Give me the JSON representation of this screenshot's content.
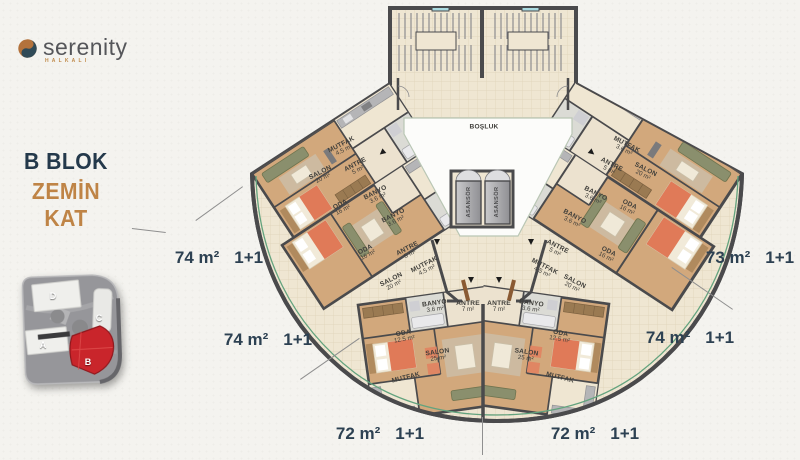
{
  "logo": {
    "name": "serenity",
    "subtitle": "HALKALI"
  },
  "headline": {
    "block": "B BLOK",
    "floor": "ZEMİN KAT"
  },
  "site_map": {
    "blocks": [
      {
        "label": "D",
        "x": 53,
        "y": 296,
        "highlighted": false
      },
      {
        "label": "C",
        "x": 99,
        "y": 318,
        "highlighted": false
      },
      {
        "label": "A",
        "x": 43,
        "y": 345,
        "highlighted": false
      },
      {
        "label": "B",
        "x": 88,
        "y": 362,
        "highlighted": true
      }
    ],
    "highlight_color": "#c9252b"
  },
  "unit_labels": [
    {
      "area": "74 m²",
      "type": "1+1",
      "x": 219,
      "y": 258
    },
    {
      "area": "74 m²",
      "type": "1+1",
      "x": 268,
      "y": 340
    },
    {
      "area": "72 m²",
      "type": "1+1",
      "x": 380,
      "y": 434
    },
    {
      "area": "72 m²",
      "type": "1+1",
      "x": 595,
      "y": 434
    },
    {
      "area": "74 m²",
      "type": "1+1",
      "x": 690,
      "y": 338
    },
    {
      "area": "73 m²",
      "type": "1+1",
      "x": 750,
      "y": 258
    }
  ],
  "room_labels": [
    {
      "t": "MUTFAK",
      "a": "4.5 m²",
      "x": 343,
      "y": 148,
      "r": -27
    },
    {
      "t": "ANTRE",
      "a": "5 m²",
      "x": 357,
      "y": 168,
      "r": -27
    },
    {
      "t": "SALON",
      "a": "20 m²",
      "x": 322,
      "y": 176,
      "r": -27
    },
    {
      "t": "ODA",
      "a": "16 m²",
      "x": 342,
      "y": 208,
      "r": -27
    },
    {
      "t": "BANYO",
      "a": "3.6 m²",
      "x": 377,
      "y": 196,
      "r": -27
    },
    {
      "t": "BANYO",
      "a": "3.6 m²",
      "x": 395,
      "y": 219,
      "r": -27
    },
    {
      "t": "ODA",
      "a": "16 m²",
      "x": 367,
      "y": 253,
      "r": -27
    },
    {
      "t": "ANTRE",
      "a": "5 m²",
      "x": 409,
      "y": 252,
      "r": -27
    },
    {
      "t": "MUTFAK",
      "a": "4.5 m²",
      "x": 426,
      "y": 268,
      "r": -27
    },
    {
      "t": "SALON",
      "a": "20 m²",
      "x": 393,
      "y": 283,
      "r": -27
    },
    {
      "t": "ODA",
      "a": "12.5 m²",
      "x": 404,
      "y": 337,
      "r": -10
    },
    {
      "t": "SALON",
      "a": "25 m²",
      "x": 438,
      "y": 356,
      "r": -8
    },
    {
      "t": "MUTFAK",
      "a": "",
      "x": 406,
      "y": 378,
      "r": -14
    },
    {
      "t": "BANYO",
      "a": "3.6 m²",
      "x": 435,
      "y": 307,
      "r": -8
    },
    {
      "t": "ANTRE",
      "a": "7 m²",
      "x": 468,
      "y": 307,
      "r": 0
    },
    {
      "t": "BOŞLUK",
      "a": "",
      "x": 484,
      "y": 127,
      "r": 0
    },
    {
      "t": "ASANSÖR",
      "a": "",
      "x": 469,
      "y": 202,
      "r": -90,
      "k": "v"
    },
    {
      "t": "ASANSÖR",
      "a": "",
      "x": 497,
      "y": 202,
      "r": -90,
      "k": "v"
    },
    {
      "t": "ANTRE",
      "a": "7 m²",
      "x": 499,
      "y": 307,
      "r": 0
    },
    {
      "t": "BANYO",
      "a": "3.6 m²",
      "x": 531,
      "y": 307,
      "r": 8
    },
    {
      "t": "SALON",
      "a": "25 m²",
      "x": 526,
      "y": 356,
      "r": 8
    },
    {
      "t": "ODA",
      "a": "12.5 m²",
      "x": 560,
      "y": 337,
      "r": 10
    },
    {
      "t": "MUTFAK",
      "a": "",
      "x": 560,
      "y": 378,
      "r": 14
    },
    {
      "t": "SALON",
      "a": "20 m²",
      "x": 573,
      "y": 285,
      "r": 27
    },
    {
      "t": "MUTFAK",
      "a": "4.5 m²",
      "x": 543,
      "y": 270,
      "r": 27
    },
    {
      "t": "ANTRE",
      "a": "5 m²",
      "x": 556,
      "y": 250,
      "r": 27
    },
    {
      "t": "ODA",
      "a": "16 m²",
      "x": 607,
      "y": 255,
      "r": 27
    },
    {
      "t": "BANYO",
      "a": "3.6 m²",
      "x": 573,
      "y": 220,
      "r": 27
    },
    {
      "t": "BANYO",
      "a": "3.6 m²",
      "x": 594,
      "y": 197,
      "r": 27
    },
    {
      "t": "ODA",
      "a": "16 m²",
      "x": 628,
      "y": 208,
      "r": 27
    },
    {
      "t": "SALON",
      "a": "20 m²",
      "x": 644,
      "y": 173,
      "r": 27
    },
    {
      "t": "ANTRE",
      "a": "5 m²",
      "x": 610,
      "y": 168,
      "r": 27
    },
    {
      "t": "MUTFAK",
      "a": "3.6 m²",
      "x": 625,
      "y": 148,
      "r": 27
    }
  ],
  "leader_lines": [
    [
      132,
      228,
      166,
      232
    ],
    [
      243,
      187,
      196,
      221
    ],
    [
      300,
      379,
      359,
      338
    ],
    [
      672,
      267,
      733,
      309
    ],
    [
      483,
      417,
      483,
      455
    ]
  ],
  "entry_arrows": [
    [
      437,
      242,
      0
    ],
    [
      531,
      242,
      0
    ],
    [
      471,
      280,
      0
    ],
    [
      499,
      280,
      0
    ],
    [
      383,
      153,
      50
    ],
    [
      591,
      153,
      -50
    ]
  ],
  "colors": {
    "accent_navy": "#2d4152",
    "accent_orange": "#bf8446",
    "wall": "#4a4a4c",
    "floor_wood": "#d2a87c",
    "floor_cream": "#efe6d2",
    "arc_green": "#63a37e",
    "site_red": "#c9252b",
    "logo_gray": "#55565a"
  }
}
